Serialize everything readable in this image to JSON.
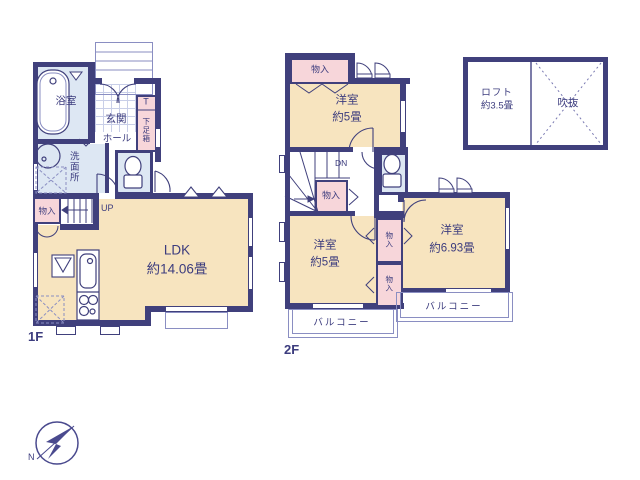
{
  "colors": {
    "wall": "#40407c",
    "text": "#3c3c7e",
    "room": "#f7e4bf",
    "wet": "#dde7f3",
    "closet": "#f7d6da",
    "thin": "#8a8ec2",
    "tile": "#c9cfe8"
  },
  "floor1": {
    "label": "1F",
    "bathroom": "浴室",
    "entrance": "玄関",
    "shoe_t": "T",
    "shoe_box": "下足箱",
    "hall": "ホール",
    "washroom": "洗面所",
    "closet": "物入",
    "up": "UP",
    "ldk": "LDK",
    "ldk_size": "約14.06畳"
  },
  "floor2": {
    "label": "2F",
    "closet_top": "物入",
    "room_n": "洋室",
    "room_n_size": "約5畳",
    "dn": "DN",
    "closet_mid": "物入",
    "room_s": "洋室",
    "room_s_size": "約5畳",
    "closet_a": "物入",
    "closet_b": "物入",
    "room_e": "洋室",
    "room_e_size": "約6.93畳",
    "balcony_l": "バルコニー",
    "balcony_r": "バルコニー"
  },
  "loft": {
    "name": "ロフト",
    "size": "約3.5畳",
    "void_label": "吹抜"
  },
  "compass": {
    "n": "N"
  }
}
